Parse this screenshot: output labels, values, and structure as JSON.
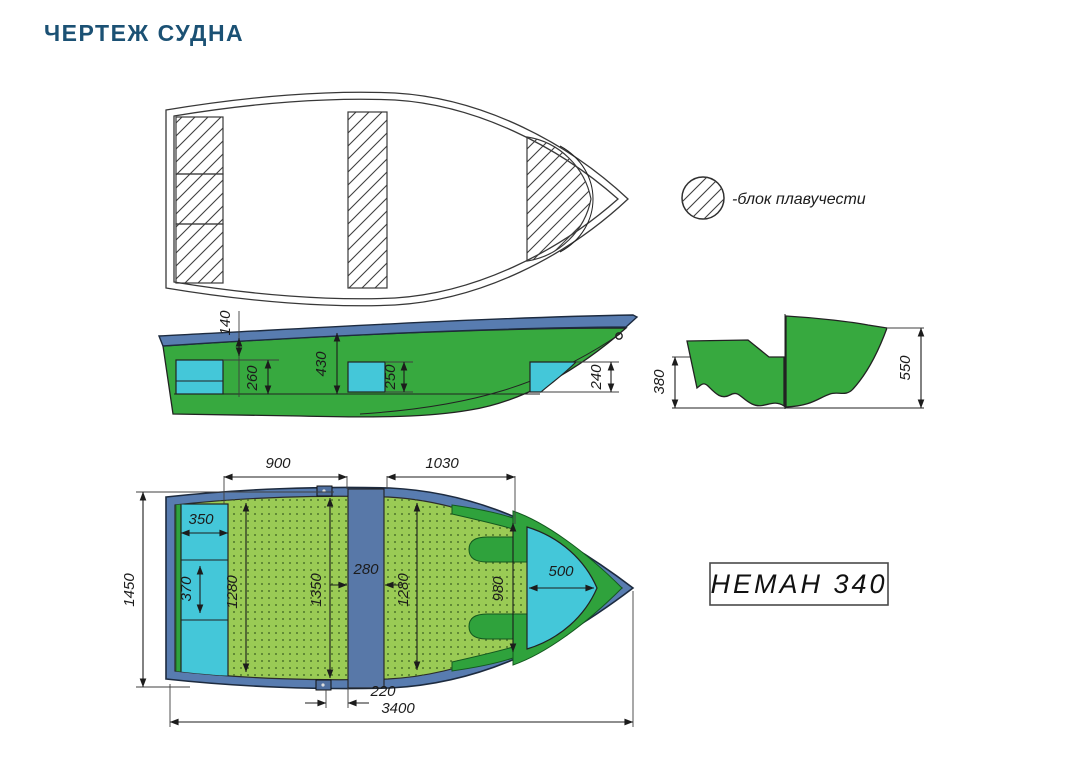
{
  "page": {
    "title": "ЧЕРТЕЖ СУДНА"
  },
  "legend": {
    "symbol": "hatched-circle",
    "label": "-блок плавучести"
  },
  "model_plate": {
    "label": "НЕМАН 340"
  },
  "colors": {
    "title": "#1b5174",
    "hull_green": "#37A93F",
    "bow_block_green": "#2FA23C",
    "floor_green": "#9ACB55",
    "floor_dot": "#50772c",
    "gunwale_blue": "#587CB0",
    "seat_cyan": "#44C7D9",
    "line": "#1c1c1c"
  },
  "views": {
    "side": {
      "name": "side-view",
      "dims": {
        "h140": "140",
        "h260": "260",
        "h430": "430",
        "h250": "250",
        "h240": "240"
      }
    },
    "transom": {
      "name": "transom-section-view",
      "dims": {
        "h380": "380",
        "h550": "550"
      }
    },
    "plan": {
      "name": "plan-view",
      "dims": {
        "w900": "900",
        "w1030": "1030",
        "w350": "350",
        "h370": "370",
        "h1280_left": "1280",
        "h1350": "1350",
        "w280": "280",
        "h1280_right": "1280",
        "h980": "980",
        "w500": "500",
        "beam1450": "1450",
        "w220": "220",
        "length3400": "3400"
      }
    }
  }
}
